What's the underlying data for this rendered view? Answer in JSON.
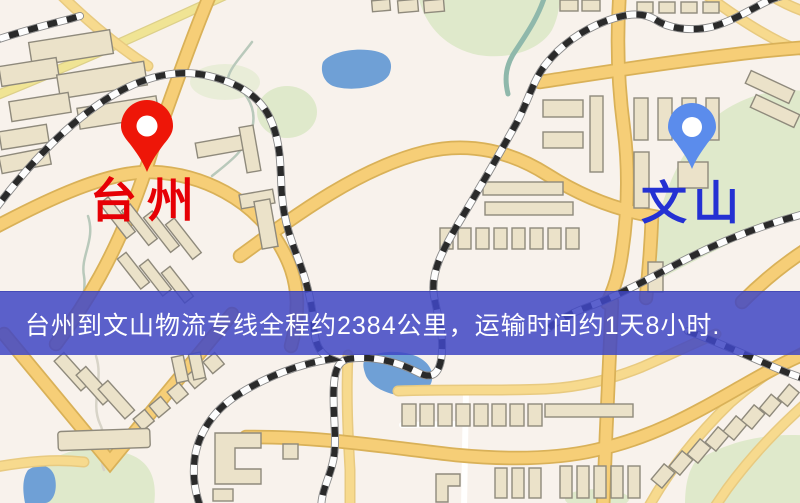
{
  "map": {
    "origin": {
      "label": "台州",
      "pin_icon": "map-pin-icon"
    },
    "destination": {
      "label": "文山",
      "pin_icon": "map-pin-icon"
    },
    "banner": {
      "text": "台州到文山物流专线全程约2384公里，运输时间约1天8小时."
    },
    "colors": {
      "background": "#f8f2ec",
      "origin_label": "#e60005",
      "origin_pin": "#ee1608",
      "destination_label": "#2431d3",
      "destination_pin": "#5b8cec",
      "banner_bg": "rgba(64,70,196,0.85)",
      "banner_text": "#ffffff",
      "road_major": "#f6ce77",
      "road_major_casing": "#d9b158",
      "road_minor": "#f7da8e",
      "road_minor_casing": "#e8ca80",
      "road_light": "#f0e494",
      "street_white": "#ffffff",
      "rail_dark": "#2a2a2a",
      "rail_light": "#fdfdfd",
      "water": "#6fa0d6",
      "park": "#dfe9cb",
      "building_fill": "#ebe2c9",
      "building_stroke": "#8f8a7c"
    }
  }
}
